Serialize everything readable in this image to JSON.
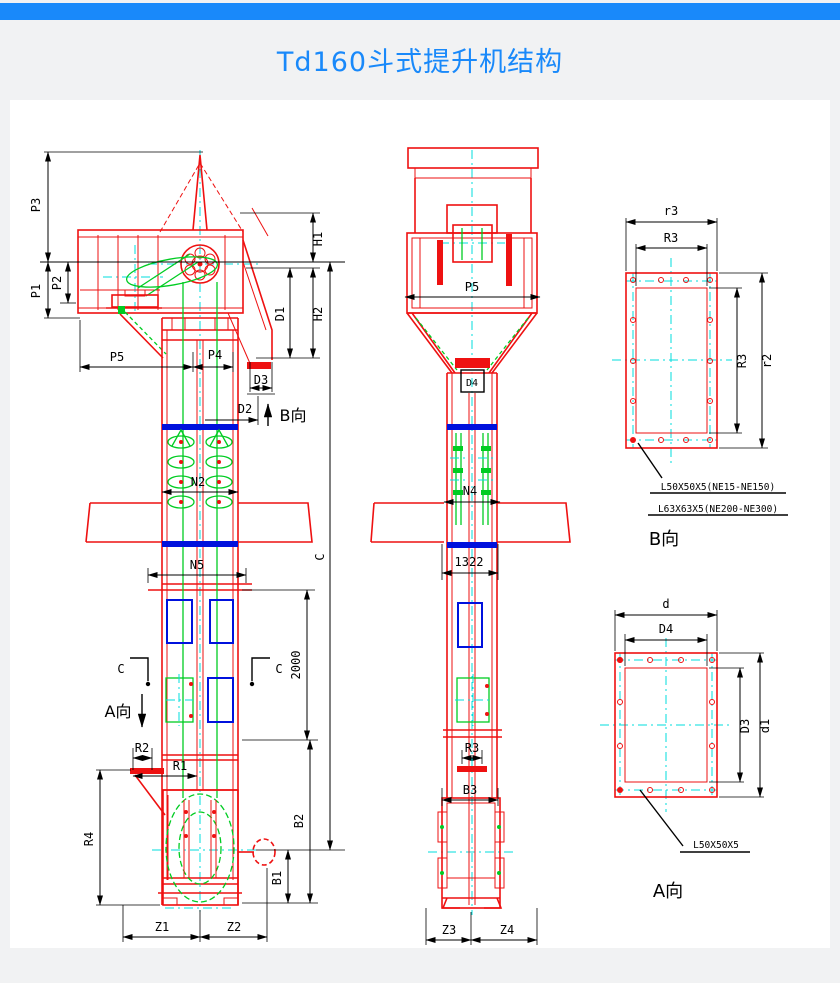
{
  "page": {
    "title": "Td160斗式提升机结构"
  },
  "palette": {
    "accent_blue": "#1989fa",
    "line_red": "#ee1111",
    "line_green": "#00cc22",
    "line_cyan": "#00dede",
    "line_blue": "#0011dd",
    "dim_black": "#000000",
    "background": "#f1f2f3",
    "paper": "#ffffff"
  },
  "front_view": {
    "dims": {
      "p3": "P3",
      "p1": "P1",
      "p2": "P2",
      "p5": "P5",
      "p4": "P4",
      "h1": "H1",
      "d1": "D1",
      "h2": "H2",
      "d3": "D3",
      "d2": "D2",
      "n2": "N2",
      "n5": "N5",
      "height_2000": "2000",
      "c_total": "C",
      "r2": "R2",
      "r1": "R1",
      "r4": "R4",
      "b2": "B2",
      "b1": "B1",
      "z1": "Z1",
      "z2": "Z2"
    },
    "section_c_left": "C",
    "section_c_right": "C",
    "view_a_marker": "A向",
    "view_b_marker": "B向"
  },
  "side_view": {
    "dims": {
      "p5": "P5",
      "d4": "D4",
      "n4": "N4",
      "w1322": "1322",
      "r3": "R3",
      "b3": "B3",
      "z3": "Z3",
      "z4": "Z4"
    }
  },
  "view_b": {
    "title": "B向",
    "dims": {
      "r3_outer": "r3",
      "r3_top": "R3",
      "r3_side": "R3",
      "r2_side": "r2"
    },
    "notes": [
      "L50X50X5(NE15-NE150)",
      "L63X63X5(NE200-NE300)"
    ]
  },
  "view_a": {
    "title": "A向",
    "dims": {
      "d_outer": "d",
      "d4_top": "D4",
      "d3_side": "D3",
      "d1_side": "d1"
    },
    "note": "L50X50X5"
  }
}
